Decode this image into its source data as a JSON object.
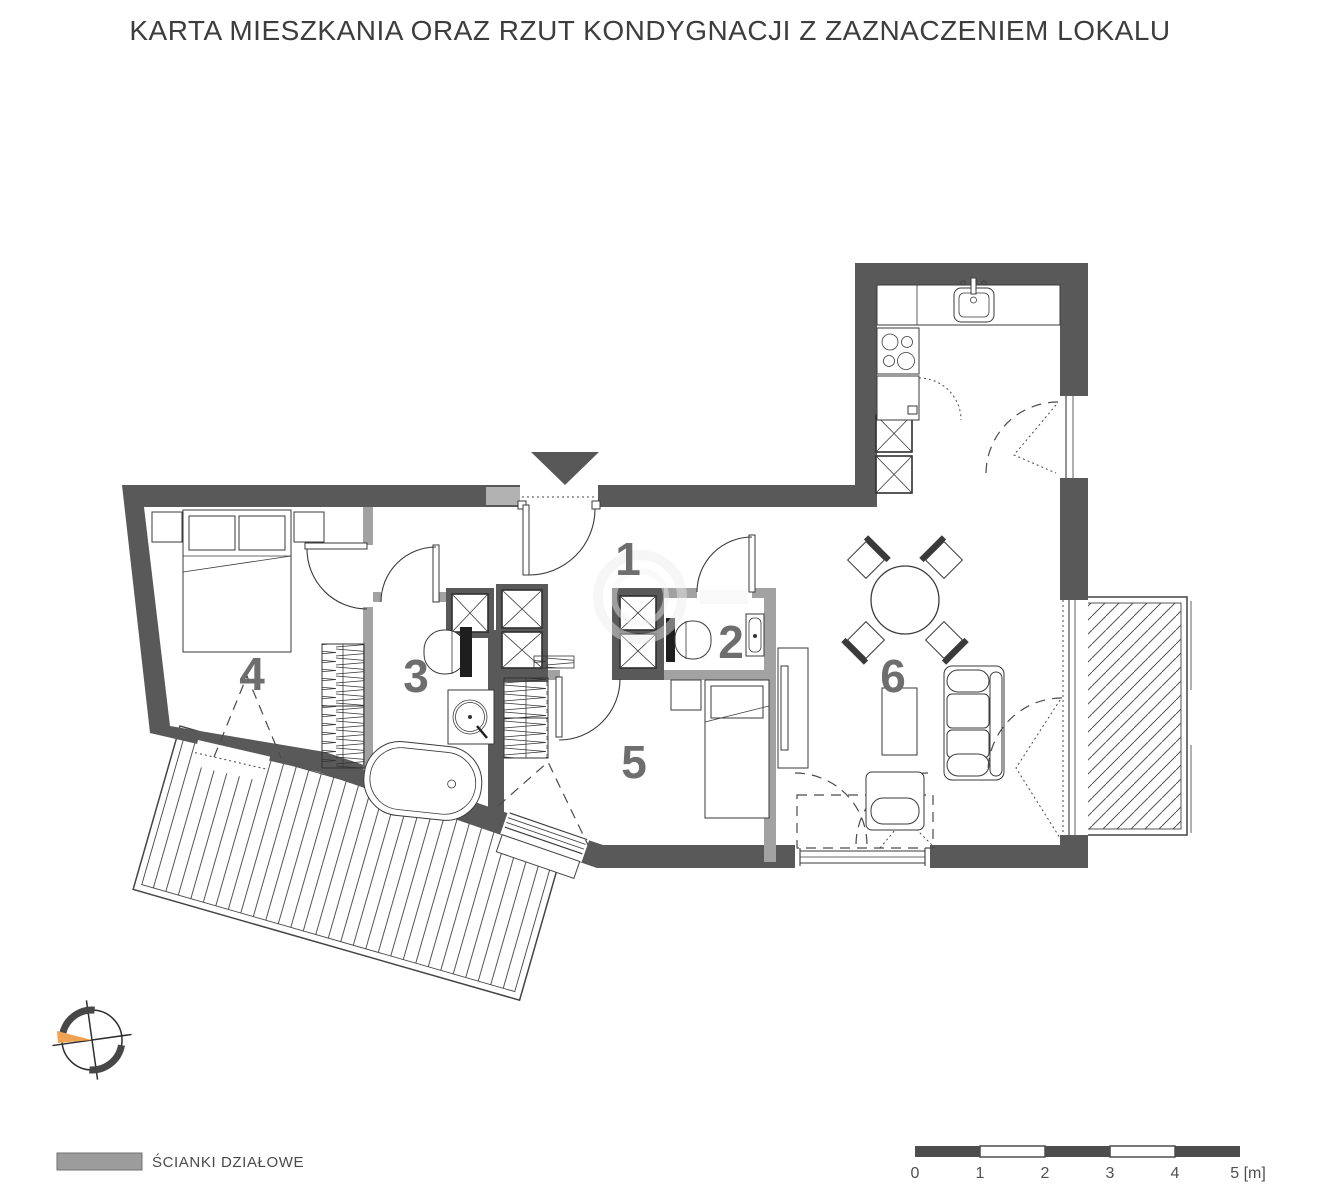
{
  "title": "KARTA MIESZKANIA ORAZ RZUT KONDYGNACJI Z ZAZNACZENIEM LOKALU",
  "rooms": [
    {
      "number": "1"
    },
    {
      "number": "2"
    },
    {
      "number": "3"
    },
    {
      "number": "4"
    },
    {
      "number": "5"
    },
    {
      "number": "6"
    }
  ],
  "legend": {
    "label": "ŚCIANKI DZIAŁOWE",
    "swatch_color": "#9c9c9c"
  },
  "scale_bar": {
    "labels": [
      "0",
      "1",
      "2",
      "3",
      "4",
      "5 [m]"
    ]
  },
  "colors": {
    "exterior_wall": "#595959",
    "partition_wall": "#a2a2a2",
    "room_number": "#6e6e6e",
    "compass_accent": "#f0a152",
    "line": "#3a3a3a"
  }
}
